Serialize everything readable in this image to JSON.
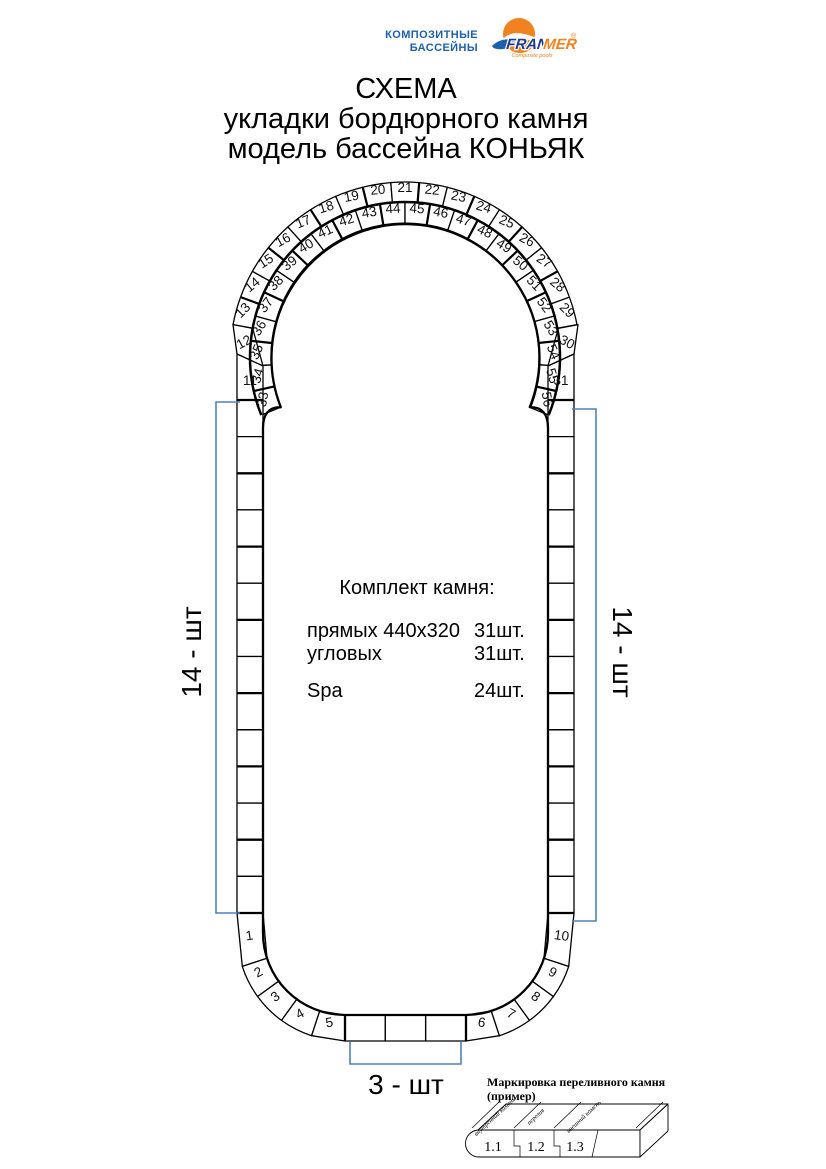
{
  "colors": {
    "accent": "#4f81bd",
    "brand_blue": "#1d5fae",
    "brand_dark_blue": "#1d3c8f",
    "brand_orange": "#f28120",
    "stroke": "#000000"
  },
  "logo": {
    "line1": "КОМПОЗИТНЫЕ",
    "line2": "БАССЕЙНЫ",
    "brand_fran": "FRAN",
    "brand_mer": "MER",
    "registered": "®",
    "tagline": "Composite pools"
  },
  "title": {
    "line1": "СХЕМА",
    "line2": "укладки бордюрного камня",
    "line3": "модель бассейна КОНЬЯК"
  },
  "kit": {
    "heading": "Комплект камня:",
    "rows": [
      {
        "label": "прямых 440x320",
        "qty": "31шт."
      },
      {
        "label": "угловых",
        "qty": "31шт."
      },
      {
        "label": "Spa",
        "qty": "24шт."
      }
    ]
  },
  "dimensions": {
    "left_count": "14 - шт",
    "right_count": "14 - шт",
    "bottom_count": "3 - шт"
  },
  "legend": {
    "title_line1": "Маркировка переливного камня",
    "title_line2": "(пример)",
    "labels": [
      "внутренний камень",
      "перелив",
      "внешний камень"
    ],
    "cells": [
      "1.1",
      "1.2",
      "1.3"
    ]
  },
  "diagram": {
    "numbers": {
      "left_shoulder": "11",
      "right_shoulder": "31",
      "outer_corner_left": "12",
      "outer_corner_right": "30",
      "outer_arc": [
        "13",
        "14",
        "15",
        "16",
        "17",
        "18",
        "19",
        "20",
        "21",
        "22",
        "23",
        "24",
        "25",
        "26",
        "27",
        "28",
        "29"
      ],
      "spa_ring": [
        "33",
        "34",
        "35",
        "36",
        "37",
        "38",
        "39",
        "40",
        "41",
        "42",
        "43",
        "44",
        "45",
        "46",
        "47",
        "48",
        "49",
        "50",
        "51",
        "52",
        "53",
        "54",
        "55",
        "56"
      ],
      "bottom_left_corner": [
        "1",
        "2",
        "3",
        "4",
        "5"
      ],
      "bottom_right_corner": [
        "6",
        "7",
        "8",
        "9",
        "10"
      ]
    },
    "straight_stones": {
      "left": 14,
      "right": 14,
      "bottom": 3
    }
  }
}
